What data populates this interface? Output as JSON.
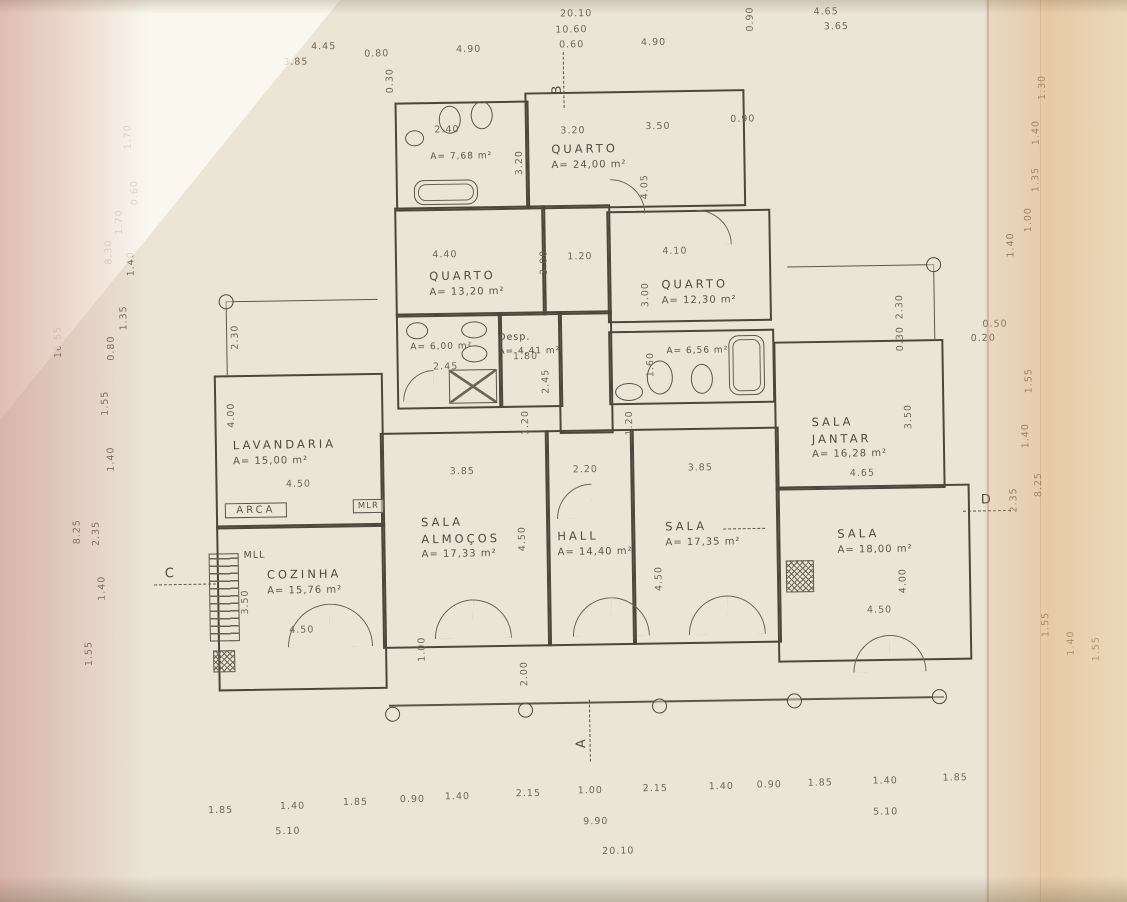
{
  "document": {
    "kind": "scanned floor plan drawing"
  },
  "rooms": [
    {
      "name": "QUARTO",
      "area": "A= 24,00 m²"
    },
    {
      "name": "QUARTO",
      "area": "A= 13,20 m²"
    },
    {
      "name": "QUARTO",
      "area": "A= 12,30 m²"
    },
    {
      "name": "",
      "area": "A= 7,68 m²"
    },
    {
      "name": "",
      "area": "A= 6,00 m²"
    },
    {
      "name": "Desp.",
      "area": "A= 4,41 m²"
    },
    {
      "name": "",
      "area": "A= 6,56 m²"
    },
    {
      "name": "LAVANDARIA",
      "area": "A= 15,00 m²"
    },
    {
      "name": "COZINHA",
      "area": "A= 15,76 m²"
    },
    {
      "name": "SALA\nALMOÇOS",
      "area": "A= 17,33 m²"
    },
    {
      "name": "HALL",
      "area": "A= 14,40 m²"
    },
    {
      "name": "SALA",
      "area": "A= 17,35 m²"
    },
    {
      "name": "SALA\nJANTAR",
      "area": "A= 16,28 m²"
    },
    {
      "name": "SALA",
      "area": "A= 18,00 m²"
    }
  ],
  "fixtures": {
    "arca": "ARCA",
    "mlr": "MLR",
    "mll": "MLL"
  },
  "markers": {
    "a": "A",
    "b": "B",
    "c": "C",
    "d": "D"
  },
  "dims": [
    {
      "t": "20.10",
      "x": 583,
      "y": 14
    },
    {
      "t": "10.60",
      "x": 578,
      "y": 30
    },
    {
      "t": "0.60",
      "x": 578,
      "y": 45
    },
    {
      "t": "3.85",
      "x": 302,
      "y": 58
    },
    {
      "t": "4.45",
      "x": 330,
      "y": 43
    },
    {
      "t": "0.80",
      "x": 383,
      "y": 51
    },
    {
      "t": "4.90",
      "x": 475,
      "y": 48
    },
    {
      "t": "4.90",
      "x": 660,
      "y": 44
    },
    {
      "t": "0.30",
      "x": 396,
      "y": 78,
      "r": 90
    },
    {
      "t": "0.90",
      "x": 757,
      "y": 22,
      "r": 90
    },
    {
      "t": "4.65",
      "x": 833,
      "y": 16
    },
    {
      "t": "3.65",
      "x": 843,
      "y": 31
    },
    {
      "t": "1.70",
      "x": 133,
      "y": 130,
      "r": 90
    },
    {
      "t": "0.60",
      "x": 139,
      "y": 186,
      "r": 90
    },
    {
      "t": "1.70",
      "x": 123,
      "y": 215,
      "r": 90
    },
    {
      "t": "8.30",
      "x": 112,
      "y": 245,
      "r": 90
    },
    {
      "t": "1.40",
      "x": 134,
      "y": 257,
      "r": 90
    },
    {
      "t": "1.35",
      "x": 126,
      "y": 311,
      "r": 90
    },
    {
      "t": "0.80",
      "x": 113,
      "y": 341,
      "r": 90
    },
    {
      "t": "16.55",
      "x": 60,
      "y": 334,
      "r": 90
    },
    {
      "t": "1.55",
      "x": 106,
      "y": 396,
      "r": 90
    },
    {
      "t": "1.40",
      "x": 111,
      "y": 452,
      "r": 90
    },
    {
      "t": "2.35",
      "x": 95,
      "y": 526,
      "r": 90
    },
    {
      "t": "8.25",
      "x": 76,
      "y": 524,
      "r": 90
    },
    {
      "t": "1.40",
      "x": 100,
      "y": 581,
      "r": 90
    },
    {
      "t": "1.55",
      "x": 86,
      "y": 646,
      "r": 90
    },
    {
      "t": "1.30",
      "x": 1048,
      "y": 95,
      "r": 90
    },
    {
      "t": "1.40",
      "x": 1041,
      "y": 140,
      "r": 90
    },
    {
      "t": "1.35",
      "x": 1040,
      "y": 187,
      "r": 90
    },
    {
      "t": "1.00",
      "x": 1032,
      "y": 227,
      "r": 90
    },
    {
      "t": "1.40",
      "x": 1014,
      "y": 252,
      "r": 90
    },
    {
      "t": "0.50",
      "x": 997,
      "y": 331
    },
    {
      "t": "0.20",
      "x": 985,
      "y": 345
    },
    {
      "t": "1.55",
      "x": 1030,
      "y": 388,
      "r": 90
    },
    {
      "t": "1.40",
      "x": 1026,
      "y": 443,
      "r": 90
    },
    {
      "t": "8.25",
      "x": 1038,
      "y": 492,
      "r": 90
    },
    {
      "t": "2.35",
      "x": 1013,
      "y": 507,
      "r": 90
    },
    {
      "t": "1.55",
      "x": 1043,
      "y": 632,
      "r": 90
    },
    {
      "t": "1.40",
      "x": 1068,
      "y": 651,
      "r": 90
    },
    {
      "t": "1.55",
      "x": 1093,
      "y": 657,
      "r": 90
    },
    {
      "t": "1.85",
      "x": 215,
      "y": 805
    },
    {
      "t": "1.40",
      "x": 287,
      "y": 802
    },
    {
      "t": "1.85",
      "x": 350,
      "y": 799
    },
    {
      "t": "0.90",
      "x": 407,
      "y": 797
    },
    {
      "t": "1.40",
      "x": 452,
      "y": 795
    },
    {
      "t": "2.15",
      "x": 523,
      "y": 793
    },
    {
      "t": "1.00",
      "x": 585,
      "y": 791
    },
    {
      "t": "2.15",
      "x": 650,
      "y": 790
    },
    {
      "t": "1.40",
      "x": 716,
      "y": 789
    },
    {
      "t": "0.90",
      "x": 764,
      "y": 788
    },
    {
      "t": "1.85",
      "x": 815,
      "y": 787
    },
    {
      "t": "1.40",
      "x": 880,
      "y": 786
    },
    {
      "t": "1.85",
      "x": 950,
      "y": 784
    },
    {
      "t": "5.10",
      "x": 282,
      "y": 827
    },
    {
      "t": "9.90",
      "x": 590,
      "y": 822
    },
    {
      "t": "5.10",
      "x": 880,
      "y": 817
    },
    {
      "t": "20.10",
      "x": 612,
      "y": 852
    },
    {
      "t": "2.40",
      "x": 452,
      "y": 128
    },
    {
      "t": "3.20",
      "x": 578,
      "y": 131
    },
    {
      "t": "3.50",
      "x": 663,
      "y": 128
    },
    {
      "t": "0.90",
      "x": 748,
      "y": 122
    },
    {
      "t": "3.20",
      "x": 524,
      "y": 162,
      "r": 90
    },
    {
      "t": "4.05",
      "x": 649,
      "y": 188,
      "r": 90
    },
    {
      "t": "4.40",
      "x": 448,
      "y": 253
    },
    {
      "t": "3.00",
      "x": 547,
      "y": 262,
      "r": 90
    },
    {
      "t": "1.20",
      "x": 583,
      "y": 257
    },
    {
      "t": "4.10",
      "x": 678,
      "y": 253
    },
    {
      "t": "3.00",
      "x": 648,
      "y": 296,
      "r": 90
    },
    {
      "t": "2.45",
      "x": 447,
      "y": 365
    },
    {
      "t": "1.80",
      "x": 527,
      "y": 356
    },
    {
      "t": "2.45",
      "x": 547,
      "y": 381,
      "r": 90
    },
    {
      "t": "1.60",
      "x": 652,
      "y": 366,
      "r": 90
    },
    {
      "t": "2.30",
      "x": 237,
      "y": 332,
      "r": 90
    },
    {
      "t": "4.00",
      "x": 232,
      "y": 410,
      "r": 90
    },
    {
      "t": "1.20",
      "x": 526,
      "y": 422,
      "r": 90
    },
    {
      "t": "1.20",
      "x": 630,
      "y": 424,
      "r": 90
    },
    {
      "t": "4.50",
      "x": 298,
      "y": 480
    },
    {
      "t": "3.85",
      "x": 462,
      "y": 470
    },
    {
      "t": "2.20",
      "x": 585,
      "y": 470
    },
    {
      "t": "3.85",
      "x": 700,
      "y": 470
    },
    {
      "t": "4.65",
      "x": 862,
      "y": 478
    },
    {
      "t": "3.50",
      "x": 909,
      "y": 422,
      "r": 90
    },
    {
      "t": "2.30",
      "x": 902,
      "y": 312,
      "r": 90
    },
    {
      "t": "0.30",
      "x": 902,
      "y": 344,
      "r": 90
    },
    {
      "t": "4.50",
      "x": 521,
      "y": 538,
      "r": 90
    },
    {
      "t": "4.50",
      "x": 657,
      "y": 580,
      "r": 90
    },
    {
      "t": "4.00",
      "x": 901,
      "y": 586,
      "r": 90
    },
    {
      "t": "3.50",
      "x": 243,
      "y": 597,
      "r": 90
    },
    {
      "t": "4.50",
      "x": 299,
      "y": 626
    },
    {
      "t": "4.50",
      "x": 877,
      "y": 615
    },
    {
      "t": "1.00",
      "x": 419,
      "y": 647,
      "r": 90
    },
    {
      "t": "2.00",
      "x": 521,
      "y": 673,
      "r": 90
    }
  ]
}
